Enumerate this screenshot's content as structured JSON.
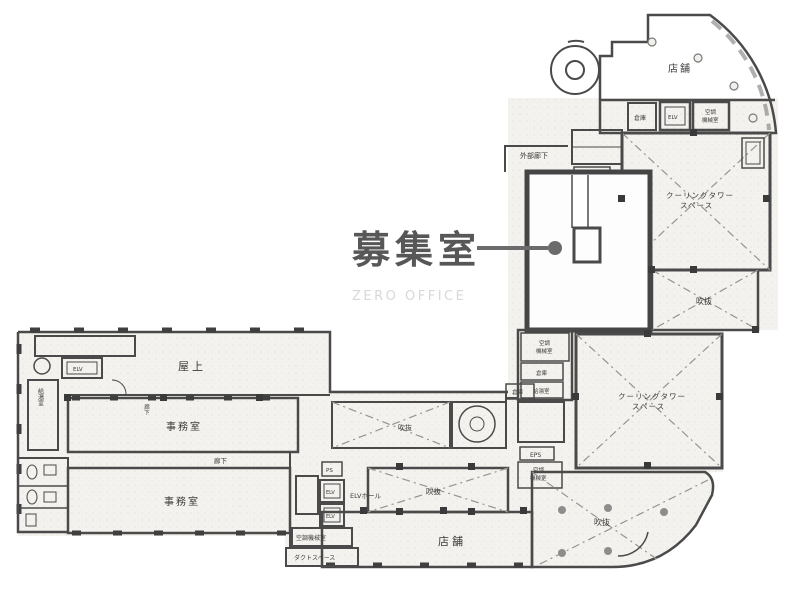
{
  "plan": {
    "callout_label": "募集室",
    "watermark": "ZERO OFFICE",
    "colors": {
      "wall": "#4a4a4a",
      "room_shade": "#d9d7d4",
      "paper": "#f4f2ee",
      "callout": "#6b6b6b",
      "watermark": "#d8d8d8"
    }
  },
  "rooms": {
    "tenpo_top": {
      "label": "店舗"
    },
    "soko_top": {
      "label": "倉庫"
    },
    "elv_top": {
      "label": "ELV"
    },
    "kucho_top": {
      "line1": "空調",
      "line2": "機械室"
    },
    "gaibu_roka": {
      "label": "外部廊下"
    },
    "eps_top": {
      "label": "EPS"
    },
    "cooling1": {
      "line1": "クーリングタワー",
      "line2": "スペース"
    },
    "fukinuke_right": {
      "label": "吹抜"
    },
    "kucho_mid": {
      "line1": "空調",
      "line2": "機械室"
    },
    "soko_mid": {
      "label": "倉庫"
    },
    "kyuto_mid": {
      "label": "給湯室"
    },
    "cooling2": {
      "line1": "クーリングタワー",
      "line2": "スペース"
    },
    "eps_low": {
      "label": "EPS"
    },
    "kucho_low": {
      "line1": "空調",
      "line2": "機械室"
    },
    "fukinuke_br": {
      "label": "吹抜"
    },
    "tenpo_bottom": {
      "label": "店舗"
    },
    "fukinuke_mid": {
      "label": "吹抜"
    },
    "fukinuke_center": {
      "label": "吹抜"
    },
    "soko_center": {
      "label": "倉庫"
    },
    "ps": {
      "label": "PS"
    },
    "elv_a": {
      "label": "ELV"
    },
    "elv_b": {
      "label": "ELV"
    },
    "elv_hall": {
      "label": "ELVホール"
    },
    "kucho_hall": {
      "label": "空調機械室"
    },
    "duct_space": {
      "label": "ダクトスペース"
    },
    "okujo": {
      "label": "屋上"
    },
    "jimushitsu1": {
      "label": "事務室"
    },
    "jimushitsu2": {
      "label": "事務室"
    },
    "roka": {
      "label": "廊下"
    },
    "roka_v": {
      "label": "廊下"
    },
    "elv_left": {
      "label": "ELV"
    },
    "kyuto_left": {
      "label": "給湯室"
    }
  }
}
